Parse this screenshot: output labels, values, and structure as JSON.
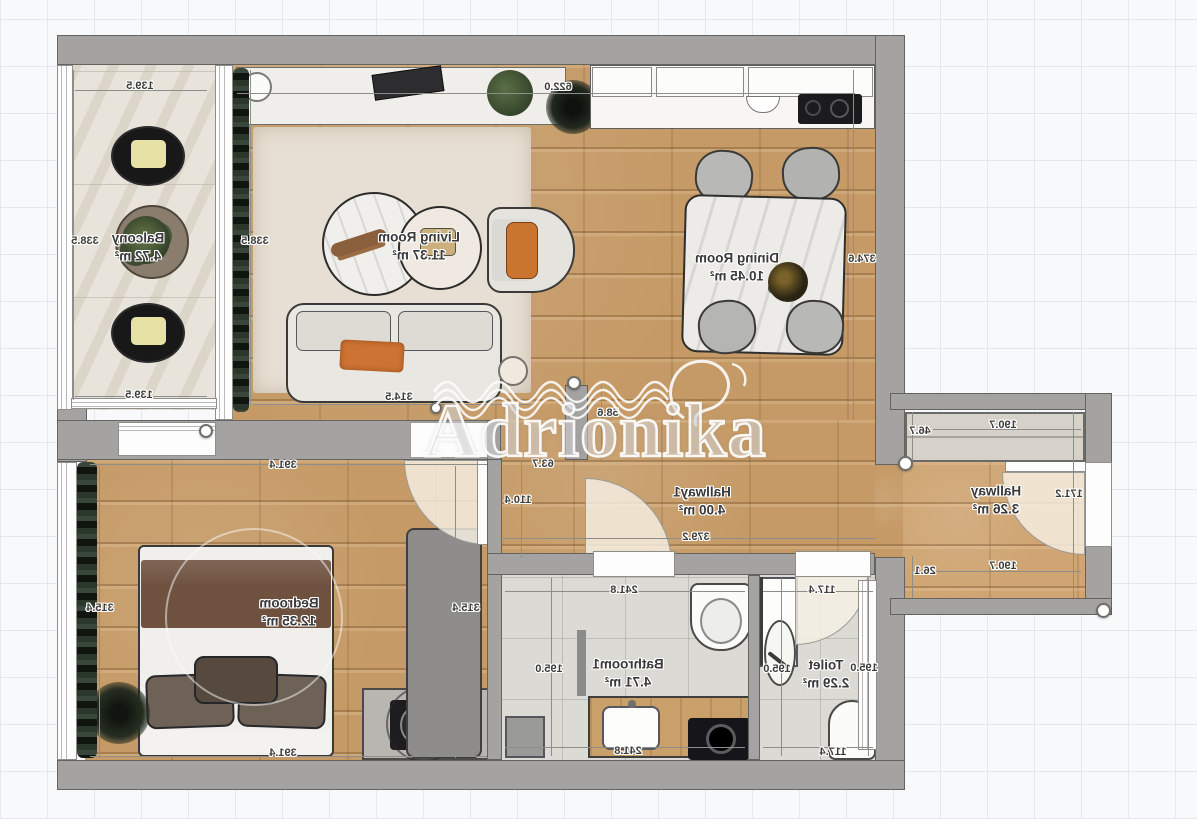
{
  "watermark": {
    "text": "Adrionika"
  },
  "palette": {
    "wall": "#a4a3a1",
    "wood_floor": "#c59a66",
    "stone_floor": "#e9e4db",
    "tile_floor": "#dbdad5",
    "accent_orange": "#cd7334",
    "curtain_green": "#242b22",
    "grid_line": "#e2e8ee"
  },
  "rooms": [
    {
      "name": "Balcony",
      "area": "4.72 m²",
      "x": 138,
      "y": 247
    },
    {
      "name": "Living Room",
      "area": "11.37 m²",
      "x": 419,
      "y": 246
    },
    {
      "name": "Dining Room",
      "area": "10.45 m²",
      "x": 737,
      "y": 267
    },
    {
      "name": "Hallway1",
      "area": "4.00 m²",
      "x": 702,
      "y": 501
    },
    {
      "name": "Hallway",
      "area": "3.26 m²",
      "x": 996,
      "y": 500
    },
    {
      "name": "Bedroom",
      "area": "12.35 m²",
      "x": 289,
      "y": 612
    },
    {
      "name": "Bathroom1",
      "area": "4.71 m²",
      "x": 628,
      "y": 673
    },
    {
      "name": "Toilet",
      "area": "2.29 m²",
      "x": 826,
      "y": 674
    }
  ],
  "dimensions": [
    {
      "v": "139.5",
      "x": 140,
      "y": 86
    },
    {
      "v": "338.5",
      "x": 85,
      "y": 241
    },
    {
      "v": "338.5",
      "x": 255,
      "y": 241
    },
    {
      "v": "139.5",
      "x": 139,
      "y": 395
    },
    {
      "v": "622.0",
      "x": 558,
      "y": 87
    },
    {
      "v": "374.6",
      "x": 862,
      "y": 259
    },
    {
      "v": "314.5",
      "x": 399,
      "y": 397
    },
    {
      "v": "58.6",
      "x": 608,
      "y": 413
    },
    {
      "v": "63.7",
      "x": 543,
      "y": 464
    },
    {
      "v": "110.4",
      "x": 518,
      "y": 500
    },
    {
      "v": "391.4",
      "x": 283,
      "y": 465
    },
    {
      "v": "315.4",
      "x": 100,
      "y": 608
    },
    {
      "v": "315.4",
      "x": 466,
      "y": 608
    },
    {
      "v": "391.4",
      "x": 283,
      "y": 753
    },
    {
      "v": "379.2",
      "x": 696,
      "y": 537
    },
    {
      "v": "241.8",
      "x": 624,
      "y": 590
    },
    {
      "v": "195.0",
      "x": 549,
      "y": 669
    },
    {
      "v": "241.8",
      "x": 628,
      "y": 751
    },
    {
      "v": "117.4",
      "x": 822,
      "y": 590
    },
    {
      "v": "195.0",
      "x": 777,
      "y": 669
    },
    {
      "v": "195.0",
      "x": 864,
      "y": 668
    },
    {
      "v": "117.4",
      "x": 833,
      "y": 752
    },
    {
      "v": "190.7",
      "x": 1003,
      "y": 425
    },
    {
      "v": "46.7",
      "x": 920,
      "y": 431
    },
    {
      "v": "171.2",
      "x": 1069,
      "y": 494
    },
    {
      "v": "190.7",
      "x": 1003,
      "y": 566
    },
    {
      "v": "26.1",
      "x": 925,
      "y": 571
    }
  ]
}
